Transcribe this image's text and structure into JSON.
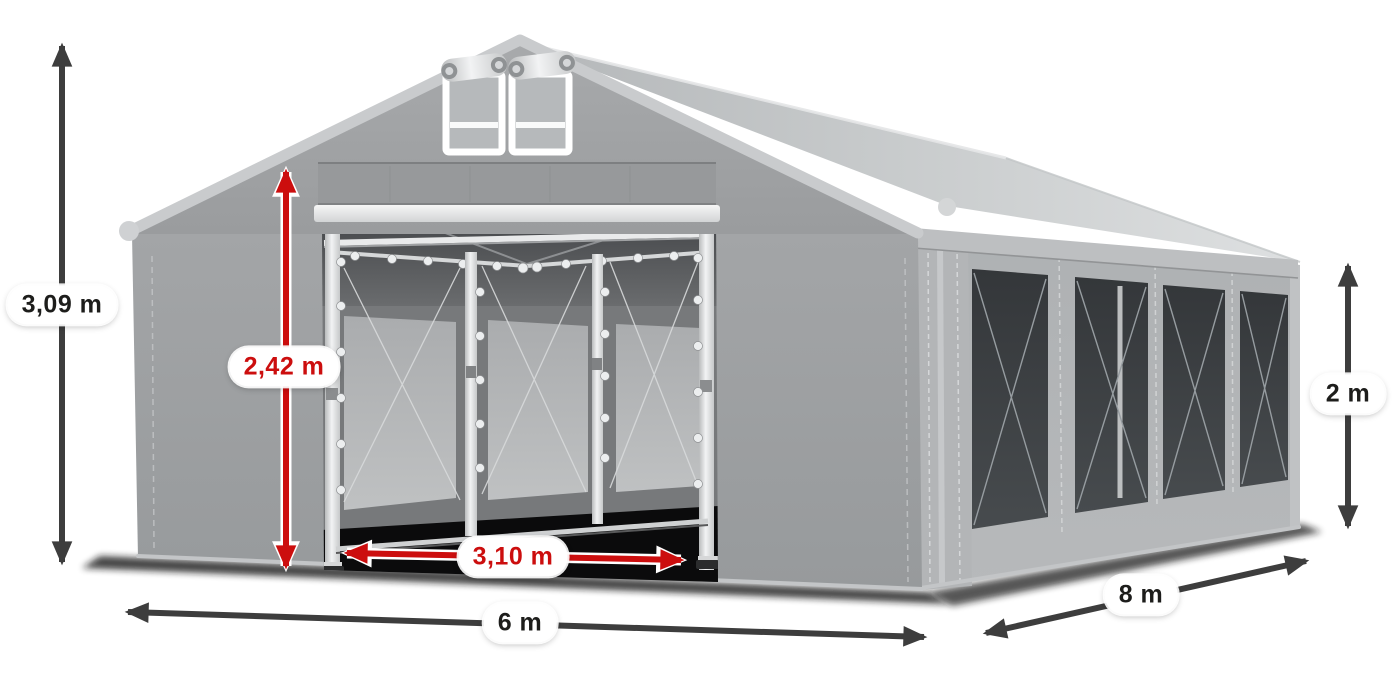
{
  "illustration": {
    "subject": "gray-party-tent-3d-render",
    "colors": {
      "arrow_dark": "#3d3d3d",
      "arrow_red": "#cc0e0e",
      "label_background": "#ffffff",
      "label_text_dark": "#1d1d1b",
      "label_text_red": "#cc0e0e",
      "tent_fabric_gray": "#9da0a2",
      "tent_roof_gray": "#cdd0d1",
      "side_window_mesh": "#3c4043"
    }
  },
  "dimensions": {
    "total_height": {
      "value": "3,09 m",
      "style": "dark",
      "orientation": "vertical",
      "measures": "overall tent height"
    },
    "door_height": {
      "value": "2,42 m",
      "style": "red",
      "orientation": "vertical",
      "measures": "entrance clear height"
    },
    "door_width": {
      "value": "3,10 m",
      "style": "red",
      "orientation": "horizontal",
      "measures": "entrance clear width"
    },
    "front_width": {
      "value": "6 m",
      "style": "dark",
      "orientation": "horizontal",
      "measures": "tent width"
    },
    "side_length": {
      "value": "8 m",
      "style": "dark",
      "orientation": "diagonal",
      "measures": "tent length"
    },
    "side_wall_height": {
      "value": "2 m",
      "style": "dark",
      "orientation": "vertical",
      "measures": "side wall height"
    }
  }
}
